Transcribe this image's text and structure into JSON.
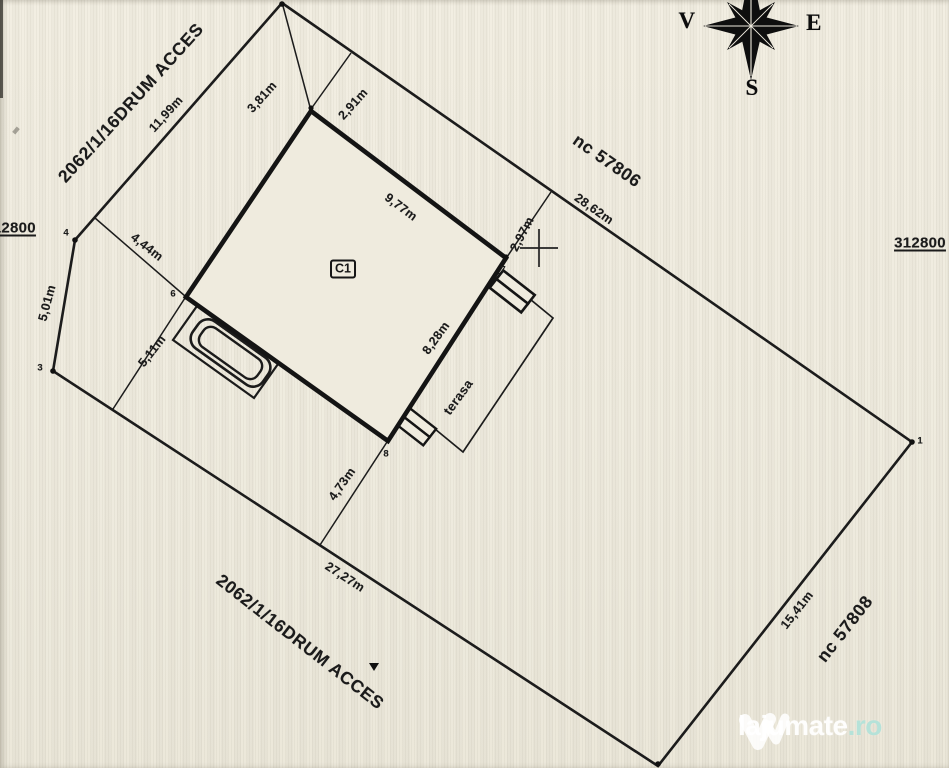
{
  "compass": {
    "west": "V",
    "east": "E",
    "south": "S"
  },
  "grid_coords": {
    "left": "312800",
    "right": "312800"
  },
  "parcels": {
    "access_road_top": "2062/1/16DRUM ACCES",
    "access_road_bottom": "2062/1/16DRUM ACCES",
    "neighbor_northeast": "nc 57806",
    "neighbor_southeast": "nc 57808"
  },
  "building": {
    "label": "C1",
    "terrace_label": "terasa"
  },
  "dimensions": {
    "boundary_northwest": "11,99m",
    "setback_north": "3,81m",
    "setback_northeast_upper": "2,91m",
    "house_wall_northeast": "9,77m",
    "setback_east": "2,97m",
    "boundary_northeast": "28,62m",
    "setback_west": "4,44m",
    "boundary_west": "5,01m",
    "setback_southwest": "5,11m",
    "house_wall_southeast": "8,28m",
    "setback_south": "4,73m",
    "boundary_southwest": "27,27m",
    "boundary_southeast": "15,41m"
  },
  "boundary_points": {
    "p1": "1",
    "p3": "3",
    "p4": "4",
    "p6": "6",
    "p7": "7",
    "p8": "8"
  },
  "watermark": {
    "brand": "lajumate",
    "tld": ".ro"
  }
}
